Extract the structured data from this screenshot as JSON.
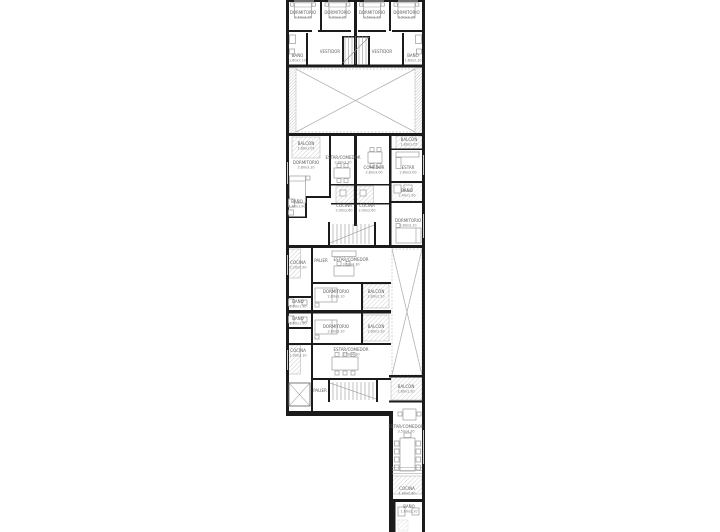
{
  "plan": {
    "colors": {
      "wall": "#1b1b1b",
      "label_text": "#5f5f5f",
      "dims_text": "#7a7a7a",
      "hatch": "#9e9e9e",
      "void_line": "#b3b3b3",
      "background": "#ffffff"
    },
    "rooms": {
      "top_dorm_1": {
        "label": "DORMITORIO",
        "dims": "2.50x3.25"
      },
      "top_dorm_2": {
        "label": "DORMITORIO",
        "dims": "2.50x3.25"
      },
      "top_dorm_3": {
        "label": "DORMITORIO",
        "dims": "2.50x3.25"
      },
      "top_dorm_4": {
        "label": "DORMITORIO",
        "dims": "2.50x3.25"
      },
      "top_bano_left": {
        "label": "BAÑO",
        "dims": "1.60x2.10"
      },
      "top_vestidor_left": {
        "label": "VESTIDOR"
      },
      "top_vestidor_right": {
        "label": "VESTIDOR"
      },
      "top_bano_right": {
        "label": "BAÑO",
        "dims": "1.60x2.10"
      },
      "u1_balcon_left": {
        "label": "BALCÓN",
        "dims": "1.80x1.05"
      },
      "u1_balcon_right": {
        "label": "BALCÓN",
        "dims": "1.80x1.05"
      },
      "u1_dorm_left": {
        "label": "DORMITORIO",
        "dims": "2.80x3.10"
      },
      "u1_estar_comedor": {
        "label": "ESTAR/COMEDOR",
        "dims": "2.80x3.30"
      },
      "u1_comedor": {
        "label": "COMEDOR",
        "dims": "2.80x3.00"
      },
      "u1_estar": {
        "label": "ESTAR",
        "dims": "2.80x3.00"
      },
      "u1_bano_left": {
        "label": "BAÑO",
        "dims": "1.60x1.90"
      },
      "u1_cocina_left": {
        "label": "COCINA",
        "dims": "2.00x2.60"
      },
      "u1_cocina_right": {
        "label": "COCINA",
        "dims": "2.00x2.60"
      },
      "u1_bano_right": {
        "label": "BAÑO",
        "dims": "2.40x1.90"
      },
      "u1_dorm_right": {
        "label": "DORMITORIO",
        "dims": "2.80x3.10"
      },
      "u2_cocina": {
        "label": "COCINA",
        "dims": "2.20x2.90"
      },
      "u2_palier": {
        "label": "PALIER"
      },
      "u2_estar_comedor": {
        "label": "ESTAR/COMEDOR",
        "dims": "3.50x4.30"
      },
      "u2_dorm": {
        "label": "DORMITORIO",
        "dims": "2.80x3.10"
      },
      "u2_balcon": {
        "label": "BALCÓN",
        "dims": "2.80x1.20"
      },
      "u2_bano": {
        "label": "BAÑO",
        "dims": "1.60x1.90"
      },
      "u3_bano": {
        "label": "BAÑO",
        "dims": "1.60x1.90"
      },
      "u3_dorm": {
        "label": "DORMITORIO",
        "dims": "2.80x3.10"
      },
      "u3_balcon": {
        "label": "BALCÓN",
        "dims": "2.80x1.20"
      },
      "u3_cocina": {
        "label": "COCINA",
        "dims": "1.90x3.10"
      },
      "u3_estar_comedor": {
        "label": "ESTAR/COMEDOR",
        "dims": "3.50x4.30"
      },
      "u3_palier": {
        "label": "PALIER"
      },
      "wing_balcon": {
        "label": "BALCÓN",
        "dims": "2.80x1.20"
      },
      "wing_estar_comedor": {
        "label": "ESTAR/COMEDOR",
        "dims": "3.50x4.30"
      },
      "wing_cocina": {
        "label": "COCINA",
        "dims": "1.90x2.80"
      },
      "wing_bano": {
        "label": "BAÑO",
        "dims": "1.60x2.10"
      }
    }
  }
}
